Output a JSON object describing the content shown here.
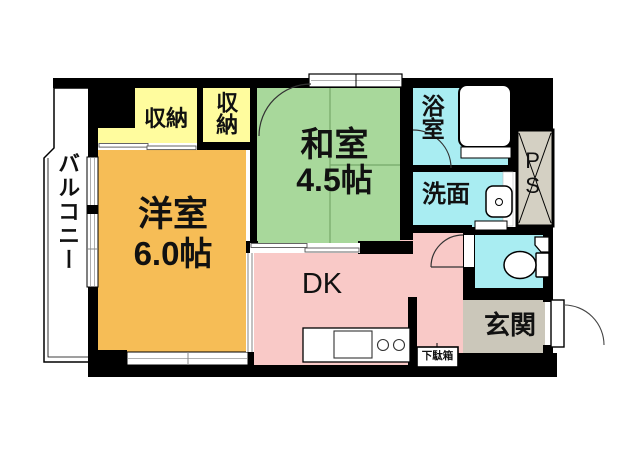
{
  "plan": {
    "type": "apartment-floor-plan",
    "labels": {
      "balcony": "バルコニー",
      "storage1": "収納",
      "storage2": "収納",
      "japanese_room_name": "和室",
      "japanese_room_size": "4.5帖",
      "western_room_name": "洋室",
      "western_room_size": "6.0帖",
      "dining_kitchen": "DK",
      "bathroom": "浴室",
      "washroom": "洗面",
      "pipe_space": "PS",
      "entrance": "玄関",
      "shoe_cabinet": "下駄箱"
    },
    "colors": {
      "storage": "#FFFC9E",
      "japanese_room": "#A8D89B",
      "japanese_room_line": "#76A869",
      "western_room": "#F6BD56",
      "dining_kitchen": "#F9C9C7",
      "wet_room": "#A9EDF2",
      "entrance": "#CBC7BA",
      "pipe_space": "#D4D0C3",
      "wall": "#000000"
    }
  }
}
